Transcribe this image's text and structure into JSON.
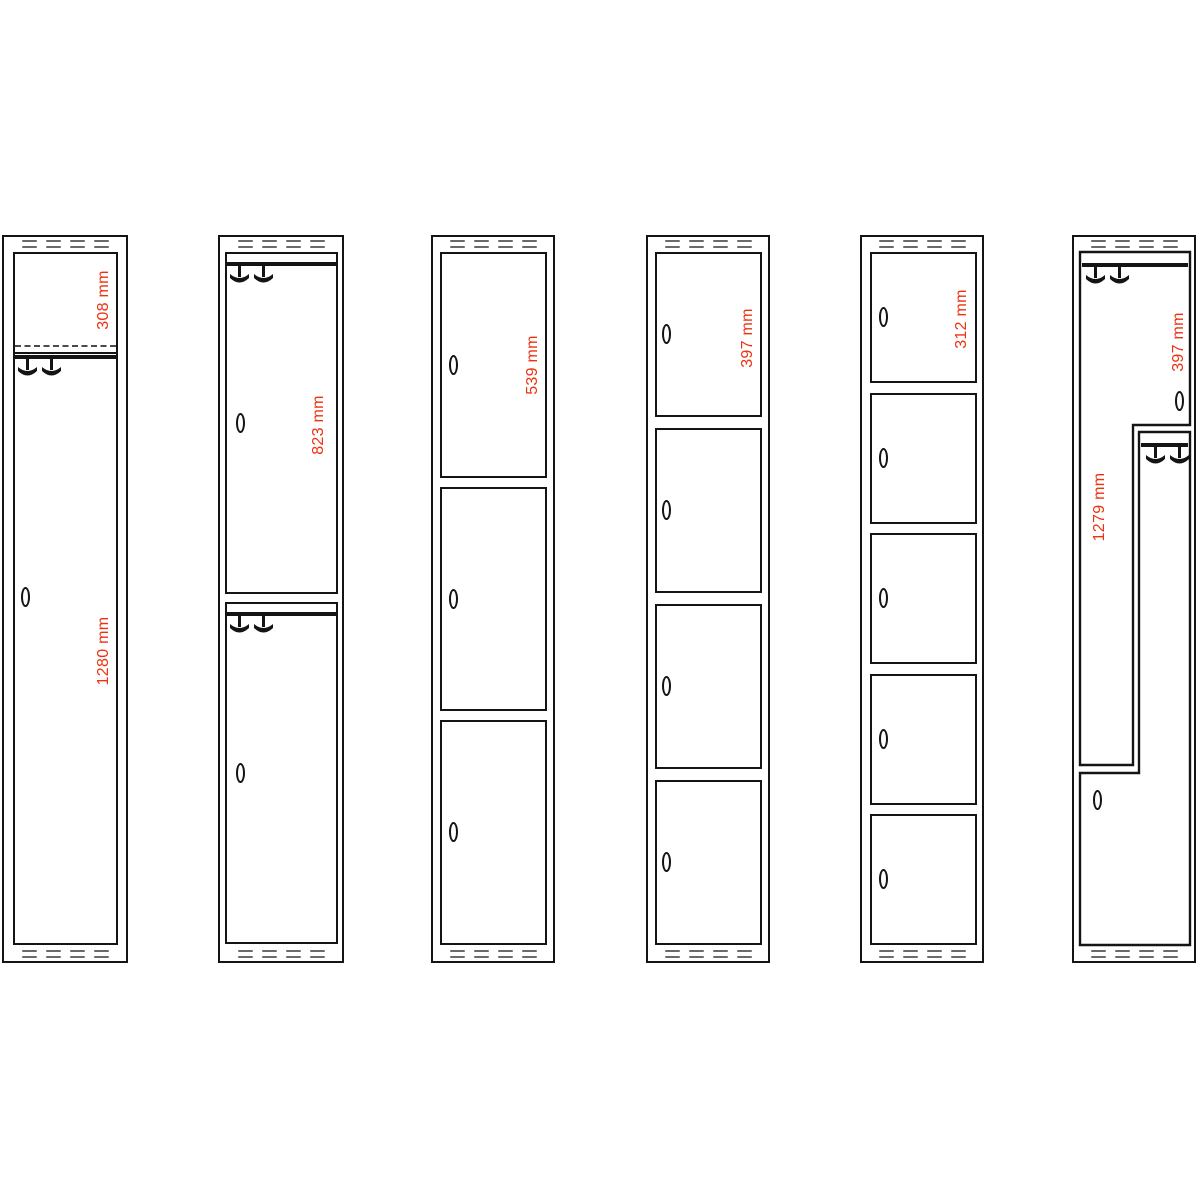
{
  "canvas": {
    "width": 1200,
    "height": 1200,
    "background": "#ffffff"
  },
  "style": {
    "line_color": "#141414",
    "vent_color": "#6a6a6a",
    "dimension_text_color": "#ee3110"
  },
  "icons": {
    "lock": "lock-icon",
    "hooks": "coat-hooks-icon",
    "vents": "ventilation-slots-icon"
  },
  "lockers": [
    {
      "id": "locker-1-compartment",
      "frame": {
        "x": 2,
        "y": 235,
        "w": 126,
        "h": 728
      },
      "doors": [
        {
          "shape": "rect",
          "x": 13,
          "y": 252,
          "w": 105,
          "h": 693,
          "shelf_dashed_y": 345,
          "shelf_thin_y": 352,
          "rail_y": 355,
          "hooks": {
            "x": 18,
            "y": 359
          },
          "lock": {
            "cx": 25,
            "cy": 597
          }
        }
      ],
      "labels": [
        {
          "text": "308 mm",
          "cx": 104,
          "cy": 300
        },
        {
          "text": "1280 mm",
          "cx": 104,
          "cy": 651
        }
      ]
    },
    {
      "id": "locker-2-compartments",
      "frame": {
        "x": 218,
        "y": 235,
        "w": 126,
        "h": 728
      },
      "doors": [
        {
          "shape": "rect",
          "x": 225,
          "y": 252,
          "w": 113,
          "h": 342,
          "rail_y": 262,
          "hooks": {
            "x": 230,
            "y": 266
          },
          "lock": {
            "cx": 240,
            "cy": 423
          }
        },
        {
          "shape": "rect",
          "x": 225,
          "y": 602,
          "w": 113,
          "h": 342,
          "rail_y": 612,
          "hooks": {
            "x": 230,
            "y": 616
          },
          "lock": {
            "cx": 240,
            "cy": 773
          }
        }
      ],
      "labels": [
        {
          "text": "823 mm",
          "cx": 319,
          "cy": 425
        }
      ]
    },
    {
      "id": "locker-3-compartments",
      "frame": {
        "x": 431,
        "y": 235,
        "w": 124,
        "h": 728
      },
      "doors": [
        {
          "shape": "rect",
          "x": 440,
          "y": 252,
          "w": 107,
          "h": 226,
          "lock": {
            "cx": 453,
            "cy": 365
          }
        },
        {
          "shape": "rect",
          "x": 440,
          "y": 487,
          "w": 107,
          "h": 224,
          "lock": {
            "cx": 453,
            "cy": 599
          }
        },
        {
          "shape": "rect",
          "x": 440,
          "y": 720,
          "w": 107,
          "h": 225,
          "lock": {
            "cx": 453,
            "cy": 832
          }
        }
      ],
      "labels": [
        {
          "text": "539 mm",
          "cx": 533,
          "cy": 365
        }
      ]
    },
    {
      "id": "locker-4-compartments",
      "frame": {
        "x": 646,
        "y": 235,
        "w": 124,
        "h": 728
      },
      "doors": [
        {
          "shape": "rect",
          "x": 655,
          "y": 252,
          "w": 107,
          "h": 165,
          "lock": {
            "cx": 666,
            "cy": 334
          }
        },
        {
          "shape": "rect",
          "x": 655,
          "y": 428,
          "w": 107,
          "h": 165,
          "lock": {
            "cx": 666,
            "cy": 510
          }
        },
        {
          "shape": "rect",
          "x": 655,
          "y": 604,
          "w": 107,
          "h": 165,
          "lock": {
            "cx": 666,
            "cy": 686
          }
        },
        {
          "shape": "rect",
          "x": 655,
          "y": 780,
          "w": 107,
          "h": 165,
          "lock": {
            "cx": 666,
            "cy": 862
          }
        }
      ],
      "labels": [
        {
          "text": "397 mm",
          "cx": 748,
          "cy": 338
        }
      ]
    },
    {
      "id": "locker-5-compartments",
      "frame": {
        "x": 860,
        "y": 235,
        "w": 124,
        "h": 728
      },
      "doors": [
        {
          "shape": "rect",
          "x": 870,
          "y": 252,
          "w": 107,
          "h": 131,
          "lock": {
            "cx": 883,
            "cy": 317
          }
        },
        {
          "shape": "rect",
          "x": 870,
          "y": 393,
          "w": 107,
          "h": 131,
          "lock": {
            "cx": 883,
            "cy": 458
          }
        },
        {
          "shape": "rect",
          "x": 870,
          "y": 533,
          "w": 107,
          "h": 131,
          "lock": {
            "cx": 883,
            "cy": 598
          }
        },
        {
          "shape": "rect",
          "x": 870,
          "y": 674,
          "w": 107,
          "h": 131,
          "lock": {
            "cx": 883,
            "cy": 739
          }
        },
        {
          "shape": "rect",
          "x": 870,
          "y": 814,
          "w": 107,
          "h": 131,
          "lock": {
            "cx": 883,
            "cy": 879
          }
        }
      ],
      "labels": [
        {
          "text": "312 mm",
          "cx": 962,
          "cy": 319
        }
      ]
    },
    {
      "id": "locker-z-doors",
      "frame": {
        "x": 1072,
        "y": 235,
        "w": 124,
        "h": 728
      },
      "doors": [
        {
          "shape": "poly",
          "points": [
            [
              1080,
              252
            ],
            [
              1190,
              252
            ],
            [
              1190,
              425
            ],
            [
              1133,
              425
            ],
            [
              1133,
              765
            ],
            [
              1080,
              765
            ]
          ],
          "rail": {
            "x1": 1082,
            "x2": 1188,
            "y": 263
          },
          "hooks": {
            "x": 1086,
            "y": 267
          },
          "lock": {
            "cx": 1179,
            "cy": 401
          }
        },
        {
          "shape": "poly",
          "points": [
            [
              1139,
              432
            ],
            [
              1190,
              432
            ],
            [
              1190,
              945
            ],
            [
              1080,
              945
            ],
            [
              1080,
              773
            ],
            [
              1139,
              773
            ]
          ],
          "rail": {
            "x1": 1141,
            "x2": 1188,
            "y": 443
          },
          "hooks": {
            "x": 1146,
            "y": 447
          },
          "lock": {
            "cx": 1097,
            "cy": 800
          }
        }
      ],
      "labels": [
        {
          "text": "397 mm",
          "cx": 1179,
          "cy": 342
        },
        {
          "text": "1279 mm",
          "cx": 1100,
          "cy": 507
        }
      ]
    }
  ]
}
